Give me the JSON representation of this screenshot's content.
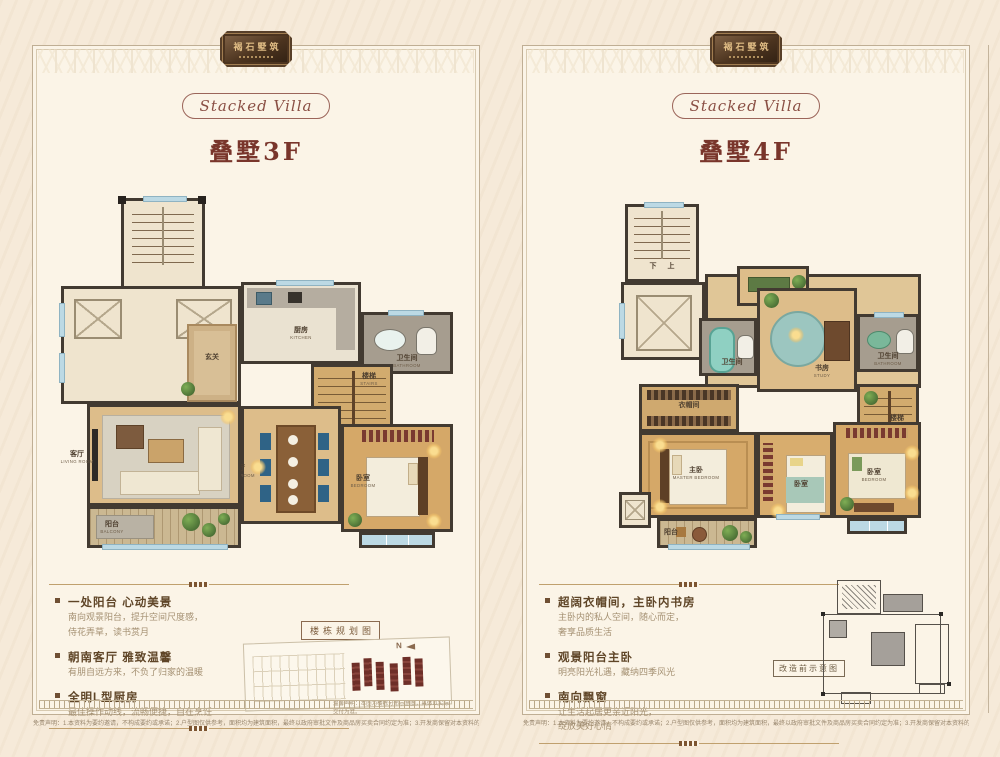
{
  "page": {
    "bg": "#f6ead9",
    "panel_bg": "#fbf4e7",
    "accent_maroon": "#79352b",
    "accent_brown": "#6f4f33",
    "wall_color": "#423a31",
    "wood_color": "#d5a868",
    "window_color": "#bcd9e4",
    "highlight_building_color": "#6e2f28"
  },
  "brand": {
    "logo_text": "褐石墅筑",
    "badge": "Stacked Villa",
    "north": "N"
  },
  "left": {
    "title": "叠墅3F",
    "rooms": [
      {
        "cn": "玄关",
        "en": ""
      },
      {
        "cn": "厨房",
        "en": "KITCHEN"
      },
      {
        "cn": "卫生间",
        "en": "BATHROOM"
      },
      {
        "cn": "楼梯",
        "en": "STAIRS"
      },
      {
        "cn": "餐厅",
        "en": "DINING ROOM"
      },
      {
        "cn": "客厅",
        "en": "LIVING ROOM"
      },
      {
        "cn": "卧室",
        "en": "BEDROOM"
      },
      {
        "cn": "阳台",
        "en": "BALCONY"
      }
    ],
    "features": [
      {
        "title": "一处阳台 心动美景",
        "line1": "南向观景阳台，提升空间尺度感，",
        "line2": "侍花弄草，读书赏月"
      },
      {
        "title": "朝南客厅 雅致温馨",
        "line1": "有朋自远方来，不负了归家的温暖"
      },
      {
        "title": "全明L型厨房",
        "line1": "最佳操作动线，流畅便捷，自在烹饪"
      }
    ],
    "siteplan_label": "楼栋规划图",
    "siteplan_caption": "温馨声明：本图为楼栋分布示意图，具体以实际交付为准。",
    "disclaimer": "免责声明：1.本资料为要约邀请，不构成要约或承诺；2.户型图仅供参考，面积均为建筑面积，最终以政府审批文件及商品房买卖合同约定为准；3.开发商保留对本资料的最终解释权。"
  },
  "right": {
    "title": "叠墅4F",
    "stair_down": "下",
    "stair_up": "上",
    "rooms": [
      {
        "cn": "卫生间",
        "en": "BATHROOM"
      },
      {
        "cn": "书房",
        "en": "STUDY"
      },
      {
        "cn": "卫生间",
        "en": "BATHROOM"
      },
      {
        "cn": "楼梯",
        "en": "STAIRS"
      },
      {
        "cn": "衣帽间",
        "en": "CLOAKROOM"
      },
      {
        "cn": "主卧",
        "en": "MASTER BEDROOM"
      },
      {
        "cn": "卧室",
        "en": "BEDROOM"
      },
      {
        "cn": "卧室",
        "en": "BEDROOM"
      },
      {
        "cn": "阳台",
        "en": "BALCONY"
      }
    ],
    "features": [
      {
        "title": "超阔衣帽间，主卧内书房",
        "line1": "主卧内的私人空间，随心而定，",
        "line2": "奢享品质生活"
      },
      {
        "title": "观景阳台主卧",
        "line1": "明亮阳光礼遇，藏纳四季风光"
      },
      {
        "title": "南向飘窗",
        "line1": "让生活起居更亲近阳光，",
        "line2": "绽放美好心情"
      }
    ],
    "schematic_label": "改造前示意图",
    "disclaimer": "免责声明：1.本资料为要约邀请，不构成要约或承诺；2.户型图仅供参考，面积均为建筑面积，最终以政府审批文件及商品房买卖合同约定为准；3.开发商保留对本资料的最终解释权。"
  }
}
